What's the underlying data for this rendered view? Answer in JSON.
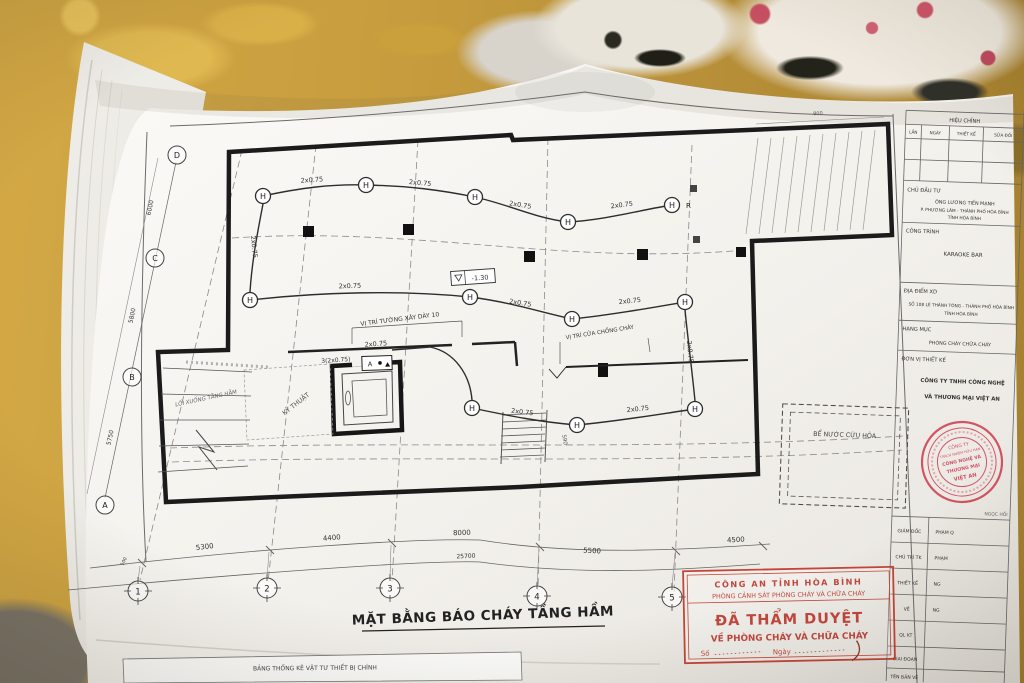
{
  "sheet": {
    "title": "MẶT BẰNG BÁO CHÁY TẦNG HẦM",
    "materials_table_title": "BẢNG THỐNG KÊ VẬT TƯ THIẾT BỊ CHÍNH"
  },
  "plan": {
    "legend": {
      "heat_detector": "H",
      "end_resistor": "R",
      "panel": "A"
    },
    "cable_2x075": "2x0.75",
    "cable_3x2075": "3(2x0.75)",
    "notes": {
      "wall": "VỊ TRÍ TƯỜNG XÂY DÀY 10",
      "fire_door": "VỊ TRÍ CỬA CHỐNG CHÁY",
      "water_tank": "BỂ NƯỚC CỨU HỎA",
      "ramp": "LỐI XUỐNG TẦNG HẦM",
      "technical_room": "KỸ THUẬT",
      "level": "-1.30",
      "stair_dim": "590"
    },
    "grid": {
      "cols": [
        "1",
        "2",
        "3",
        "4",
        "5"
      ],
      "rows_top_to_bottom": [
        "D",
        "C",
        "B",
        "A"
      ]
    },
    "dims": {
      "bottom": [
        "100",
        "5300",
        "4400",
        "8000",
        "5500",
        "4500"
      ],
      "bottom_total": "25700",
      "left": [
        "6000",
        "5800",
        "5750"
      ],
      "top_right": "800"
    }
  },
  "titleblock": {
    "revision": {
      "header": "HIỆU CHỈNH",
      "cols": [
        "LẦN",
        "NGÀY",
        "THIẾT KẾ",
        "SỬA ĐỔI"
      ]
    },
    "sections": [
      {
        "label": "CHỦ ĐẦU TƯ",
        "values": [
          "ÔNG LƯƠNG TIẾN MẠNH",
          "P. PHƯƠNG LÂM - THÀNH PHỐ HÒA BÌNH",
          "TỈNH HÒA BÌNH"
        ]
      },
      {
        "label": "CÔNG TRÌNH",
        "values": [
          "KARAOKE BAR"
        ]
      },
      {
        "label": "ĐỊA ĐIỂM XD",
        "values": [
          "SỐ 108 LÊ THÁNH TÔNG - THÀNH PHỐ HÒA BÌNH",
          "TỈNH HÒA BÌNH"
        ]
      },
      {
        "label": "HẠNG MỤC",
        "values": [
          "PHÒNG CHÁY CHỮA CHÁY"
        ]
      },
      {
        "label": "ĐƠN VỊ THIẾT KẾ",
        "values": [
          "CÔNG TY TNHH CÔNG NGHỆ",
          "VÀ THƯƠNG MẠI VIỆT AN"
        ]
      }
    ],
    "footnote": "NGỌC HỒI",
    "credits": [
      {
        "label": "GIÁM ĐỐC",
        "value": "PHẠM Q"
      },
      {
        "label": "CHỦ TRÌ TK",
        "value": "PHẠM"
      },
      {
        "label": "THIẾT KẾ",
        "value": "NG"
      },
      {
        "label": "VẼ",
        "value": "NG"
      },
      {
        "label": "QL KT",
        "value": ""
      },
      {
        "label": "GIAI ĐOẠN",
        "value": ""
      },
      {
        "label": "TÊN BẢN VẼ",
        "value": ""
      }
    ]
  },
  "stamps": {
    "approval": {
      "line1": "CÔNG AN TỈNH HÒA BÌNH",
      "line2": "PHÒNG CẢNH SÁT PHÒNG CHÁY VÀ CHỮA CHÁY",
      "line3": "ĐÃ THẨM DUYỆT",
      "line4": "VỀ PHÒNG CHÁY VÀ CHỮA CHÁY",
      "so_label": "Số",
      "ngay_label": "Ngày",
      "color": "#bf3a30"
    },
    "company_seal": {
      "lines": [
        "CÔNG TY",
        "TRÁCH NHIỆM HỮU HẠN",
        "CÔNG NGHỆ VÀ",
        "THƯƠNG MẠI",
        "VIỆT AN"
      ],
      "color": "#cf4455"
    }
  }
}
